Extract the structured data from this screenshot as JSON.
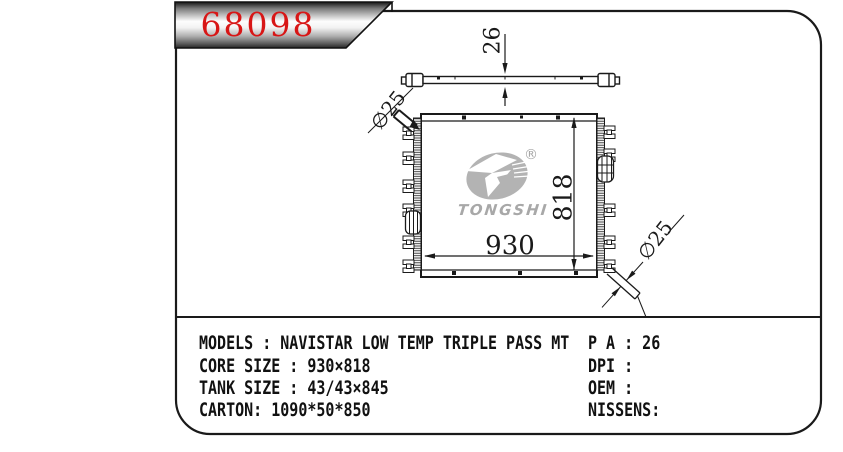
{
  "part_number": "68098",
  "logo": {
    "name": "TONGSHI",
    "registered_mark": "®"
  },
  "dimensions": {
    "core_thickness": "26",
    "core_height": "818",
    "core_width": "930",
    "inlet_diameter": "∅25",
    "outlet_diameter": "∅25"
  },
  "specs": {
    "left_rows": [
      "MODELS : NAVISTAR LOW TEMP TRIPLE PASS MT",
      "CORE SIZE : 930×818",
      "TANK SIZE : 43/43×845",
      "CARTON: 1090*50*850"
    ],
    "right_rows": [
      "P A : 26",
      "DPI :",
      "OEM :",
      "NISSENS:"
    ]
  },
  "colors": {
    "part_number_red": "#d81616",
    "watermark_gray": "#b0b0b0",
    "line_black": "#1a1a1a"
  }
}
